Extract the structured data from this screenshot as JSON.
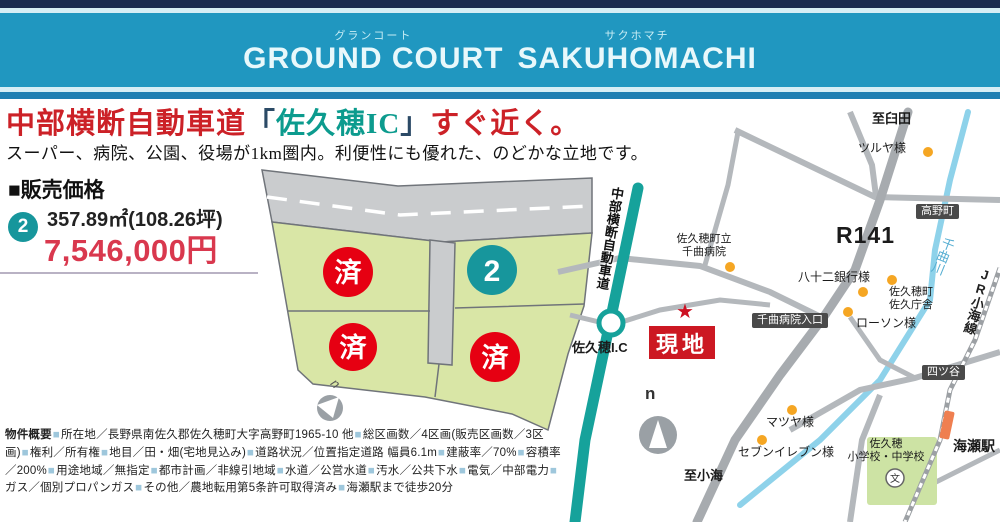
{
  "header": {
    "furigana_left": "グランコート",
    "title_left": "GROUND COURT",
    "furigana_right": "サクホマチ",
    "title_right": "SAKUHOMACHI"
  },
  "headline": {
    "pre": "中部横断自動車道",
    "bracket_open": "「",
    "highlight": "佐久穂IC",
    "bracket_close": "」",
    "post": "すぐ近く。",
    "subtitle": "スーパー、病院、公園、役場が1km圏内。利便性にも優れた、のどかな立地です。"
  },
  "price": {
    "section_title": "■販売価格",
    "lot_number": "2",
    "area": "357.89㎡(108.26坪)",
    "price": "7,546,000円"
  },
  "site_plan": {
    "sold_label": "済",
    "available_lot": "2",
    "compass": "n"
  },
  "map": {
    "to_usuda": "至臼田",
    "tsuruya": "ツルヤ様",
    "takanomachi": "高野町",
    "r141": "R141",
    "chikuma_river": "千曲川",
    "jr_koumi_line": "JR小海線",
    "expressway": "中部横断自動車道",
    "hospital_line1": "佐久穂町立",
    "hospital_line2": "千曲病院",
    "bank": "八十二銀行様",
    "town_office_line1": "佐久穂町",
    "town_office_line2": "佐久庁舎",
    "hospital_entrance": "千曲病院入口",
    "lawson": "ローソン様",
    "yotsuya": "四ツ谷",
    "site_marker": "現地",
    "star": "★",
    "sakuho_ic": "佐久穂I.C",
    "compass": "n",
    "matsuya": "マツヤ様",
    "seven_eleven": "セブンイレブン様",
    "to_koumi": "至小海",
    "school_line1": "佐久穂",
    "school_line2": "小学校・中学校",
    "school_symbol": "文",
    "kaize_station": "海瀬駅"
  },
  "property": {
    "lead": "物件概要",
    "bullet": "■",
    "items": [
      "所在地／長野県南佐久郡佐久穂町大字高野町1965-10 他",
      "総区画数／4区画(販売区画数／3区画)",
      "権利／所有権",
      "地目／田・畑(宅地見込み)",
      "道路状況／位置指定道路 幅員6.1m",
      "建蔽率／70%",
      "容積率／200%",
      "用途地域／無指定",
      "都市計画／非線引地域",
      "水道／公営水道",
      "汚水／公共下水",
      "電気／中部電力",
      "ガス／個別プロパンガス",
      "その他／農地転用第5条許可取得済み",
      "海瀬駅まで徒歩20分"
    ]
  },
  "colors": {
    "header_teal": "#2097c0",
    "header_navy": "#1a2c50",
    "headline_red": "#cc2127",
    "highlight_teal": "#0c9b8e",
    "price_red": "#d9384e",
    "sold_red": "#e60012",
    "lot_teal": "#17969c",
    "highway_teal": "#16a29b",
    "river_blue": "#8ed2ea",
    "poi_orange": "#f5a623",
    "lot_green": "#d9e6a6"
  }
}
